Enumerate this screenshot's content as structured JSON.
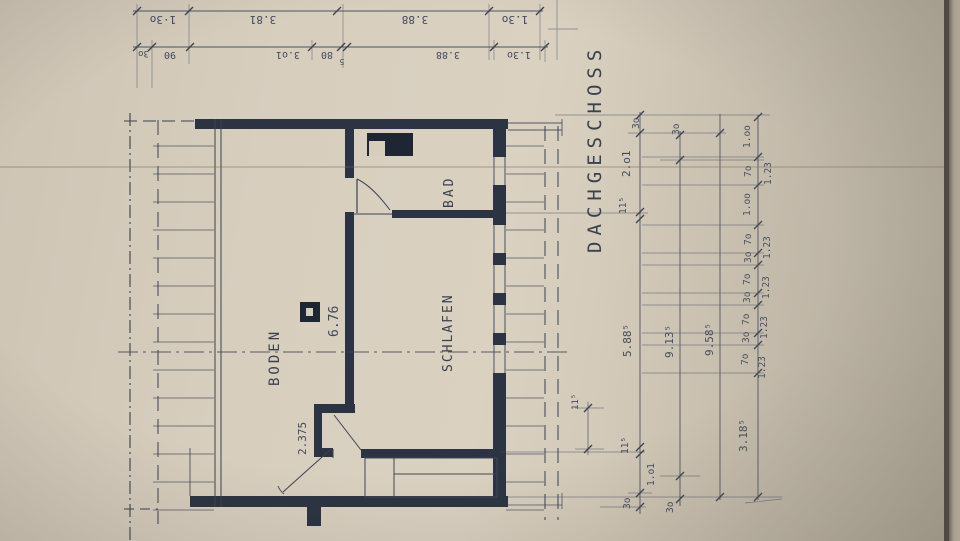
{
  "drawing": {
    "floor_label": "DACHGESCHOSS",
    "rooms": {
      "boden": "BODEN",
      "schlafen": "SCHLAFEN",
      "bad": "BAD"
    },
    "inline_dims": {
      "boden_length": "6.76",
      "boden_door": "2.375",
      "wall_thickness": "11⁵"
    },
    "top_dim_rows": {
      "outer": [
        "1·3o",
        "3.81",
        "3.88",
        "1.3o"
      ],
      "inner": [
        "3o",
        "90",
        "3.o1",
        "80",
        "3.88",
        "1.3o"
      ],
      "inner_tick_sup": "5"
    },
    "side_dim_chains": {
      "chain1": [
        "3o",
        "2.o1",
        "11⁵",
        "5.88⁵",
        "11⁵",
        "1.o1",
        "3o"
      ],
      "chain2": [
        "3o",
        "9.13⁵",
        "3o"
      ],
      "chain3_total": "9.58⁵",
      "chain4": [
        "1.oo",
        "7o",
        "1.oo",
        "7o",
        "3o",
        "7o",
        "3o",
        "7o",
        "3o",
        "7o",
        "3.18⁵"
      ],
      "window_height": "1.23"
    }
  }
}
